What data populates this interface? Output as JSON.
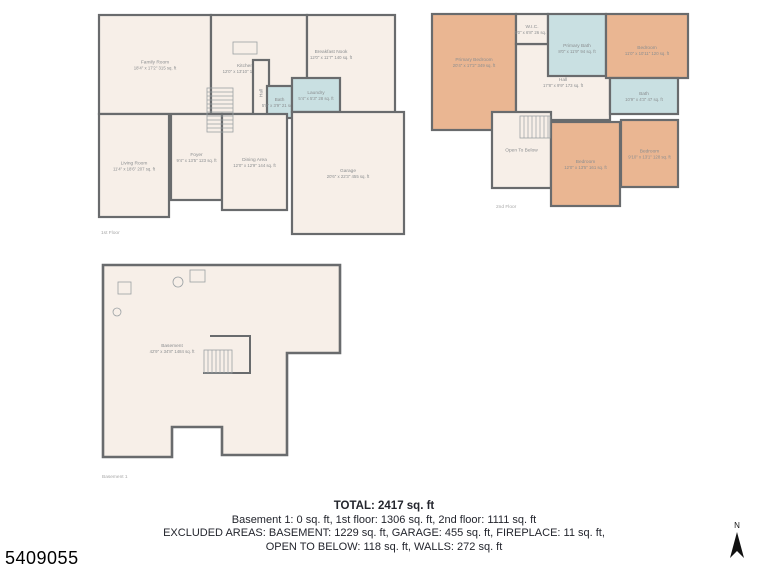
{
  "page": {
    "id_number": "5409055",
    "compass_label": "N"
  },
  "summary": {
    "line1": "TOTAL: 2417 sq. ft",
    "line2": "Basement 1: 0 sq. ft, 1st floor: 1306 sq. ft, 2nd floor: 1111 sq. ft",
    "line3": "EXCLUDED AREAS: BASEMENT: 1229 sq. ft, GARAGE: 455 sq. ft, FIREPLACE: 11 sq. ft,",
    "line4": "OPEN TO BELOW: 118 sq. ft, WALLS: 272 sq. ft"
  },
  "colors": {
    "wall": "#696b6d",
    "floor": "#f7efe8",
    "bedroom": "#eab692",
    "bath": "#c9e0e2",
    "label": "#8b8e90",
    "caption": "#a8a8a8",
    "fixture": "#9aa0a3"
  },
  "floors": [
    {
      "label": "1st Floor",
      "w": 322,
      "h": 230,
      "cap": [
        6,
        222
      ],
      "rooms": [
        {
          "name": "Family Room",
          "dims": "18'4\" x 17'2\" 315 sq. ft",
          "fill": "floor",
          "rect": [
            4,
            3,
            112,
            99
          ]
        },
        {
          "name": "Kitchen",
          "dims": "12'0\" x 13'10\" 173 sq. ft",
          "fill": "floor",
          "rect": [
            116,
            3,
            96,
            99
          ],
          "lx": 150,
          "ly": 56
        },
        {
          "name": "Breakfast Nook",
          "dims": "12'0\" x 11'7\" 140 sq. ft",
          "fill": "floor",
          "rect": [
            212,
            3,
            88,
            99
          ],
          "lx": 236,
          "ly": 42
        },
        {
          "name": "Hall",
          "fill": "floor",
          "rect": [
            158,
            48,
            16,
            66
          ],
          "vertical": true
        },
        {
          "name": "Bath",
          "dims": "5'8\" x 3'9\" 21 sq. ft",
          "fill": "bath",
          "rect": [
            172,
            74,
            25,
            32
          ]
        },
        {
          "name": "Laundry",
          "dims": "5'4\" x 5'3\" 28 sq. ft",
          "fill": "bath",
          "rect": [
            197,
            66,
            48,
            34
          ]
        },
        {
          "name": "Living Room",
          "dims": "11'4\" x 18'6\" 207 sq. ft",
          "fill": "floor",
          "rect": [
            4,
            102,
            70,
            103
          ]
        },
        {
          "name": "Foyer",
          "dims": "9'4\" x 13'5\" 123 sq. ft",
          "fill": "floor",
          "rect": [
            76,
            102,
            51,
            86
          ]
        },
        {
          "name": "Dining Area",
          "dims": "12'0\" x 12'9\" 144 sq. ft",
          "fill": "floor",
          "rect": [
            127,
            102,
            65,
            96
          ]
        },
        {
          "name": "Garage",
          "dims": "20'6\" x 22'3\" 455 sq. ft",
          "fill": "floor",
          "rect": [
            197,
            100,
            112,
            122
          ]
        }
      ],
      "fixtures": [
        {
          "type": "rect",
          "x": 138,
          "y": 30,
          "w": 24,
          "h": 12
        },
        {
          "type": "stairs",
          "x": 112,
          "y": 76,
          "w": 26,
          "h": 44,
          "dir": "h"
        }
      ]
    },
    {
      "label": "2nd Floor",
      "w": 262,
      "h": 204,
      "cap": [
        68,
        198
      ],
      "rooms": [
        {
          "name": "Primary Bedroom",
          "dims": "20'4\" x 17'2\" 349 sq. ft",
          "fill": "bedroom",
          "rect": [
            4,
            4,
            84,
            116
          ],
          "ly": 52
        },
        {
          "name": "Hall",
          "dims": "17'8\" x 9'9\" 173 sq. ft",
          "fill": "floor",
          "rect": [
            88,
            34,
            94,
            76
          ],
          "ly": 72
        },
        {
          "name": "W.I.C.",
          "dims": "4'0\" x 6'8\" 26 sq. ft",
          "fill": "floor",
          "rect": [
            88,
            4,
            32,
            30
          ]
        },
        {
          "name": "Primary Bath",
          "dims": "8'0\" x 11'9\" 94 sq. ft",
          "fill": "bath",
          "rect": [
            120,
            4,
            58,
            62
          ],
          "ly": 38
        },
        {
          "name": "Bedroom",
          "dims": "11'0\" x 10'11\" 120 sq. ft",
          "fill": "bedroom",
          "rect": [
            178,
            4,
            82,
            64
          ],
          "ly": 40
        },
        {
          "name": "Bath",
          "dims": "10'9\" x 4'3\" 47 sq. ft",
          "fill": "bath",
          "rect": [
            182,
            68,
            68,
            36
          ]
        },
        {
          "name": "Open To Below",
          "fill": "floor",
          "rect": [
            64,
            102,
            59,
            76
          ]
        },
        {
          "name": "Bedroom",
          "dims": "12'0\" x 13'5\" 161 sq. ft",
          "fill": "bedroom",
          "rect": [
            123,
            112,
            69,
            84
          ]
        },
        {
          "name": "Bedroom",
          "dims": "9'10\" x 13'1\" 128 sq. ft",
          "fill": "bedroom",
          "rect": [
            193,
            110,
            57,
            67
          ]
        }
      ],
      "fixtures": [
        {
          "type": "stairs",
          "x": 92,
          "y": 106,
          "w": 30,
          "h": 22,
          "dir": "v"
        }
      ]
    },
    {
      "label": "Basement 1",
      "w": 252,
      "h": 228,
      "cap": [
        4,
        220
      ],
      "outline": "5,7 242,7 242,95 189,95 189,197 124,197 124,169 74,169 74,199 5,199",
      "rooms": [
        {
          "name": "Basement",
          "dims": "42'9\" x 34'8\" 1484 sq. ft",
          "lx": 74,
          "ly": 90
        }
      ],
      "fixtures": [
        {
          "type": "path",
          "d": "M112,78 L152,78 L152,115 L105,115"
        },
        {
          "type": "stairs",
          "x": 106,
          "y": 92,
          "w": 28,
          "h": 23,
          "dir": "v"
        },
        {
          "type": "rect",
          "x": 20,
          "y": 24,
          "w": 13,
          "h": 12
        },
        {
          "type": "rect",
          "x": 92,
          "y": 12,
          "w": 15,
          "h": 12
        },
        {
          "type": "circle",
          "cx": 80,
          "cy": 24,
          "r": 5
        },
        {
          "type": "circle",
          "cx": 19,
          "cy": 54,
          "r": 4
        }
      ]
    }
  ]
}
